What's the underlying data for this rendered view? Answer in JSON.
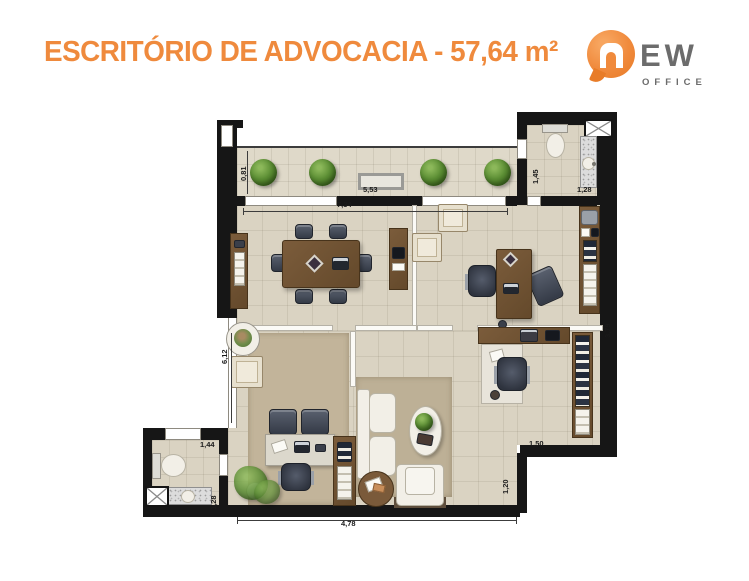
{
  "header": {
    "title": "ESCRITÓRIO DE ADVOCACIA - 57,64 m²",
    "logo": {
      "ew": "EW",
      "office": "OFFICE"
    }
  },
  "plan": {
    "dimensions": {
      "balcony_depth": "0,81",
      "balcony_width": "5,53",
      "interior_width": "7,34",
      "wc_top_height": "1,45",
      "wc_top_width": "1,28",
      "right_height": "3,79",
      "left_height": "6,12",
      "wc_bottom_width": "1,44",
      "wc_bottom_height": "1,28",
      "right_office_width": "1,50",
      "right_step_height": "1,20",
      "bottom_width": "4,78"
    },
    "colors": {
      "accent_orange": "#EF8A3D",
      "wall_black": "#161616",
      "floor_beige": "#DAD3C2",
      "rug_tan": "#C2B49A",
      "wood_brown": "#6E5133",
      "plant_green": "#4F7F2E"
    }
  }
}
